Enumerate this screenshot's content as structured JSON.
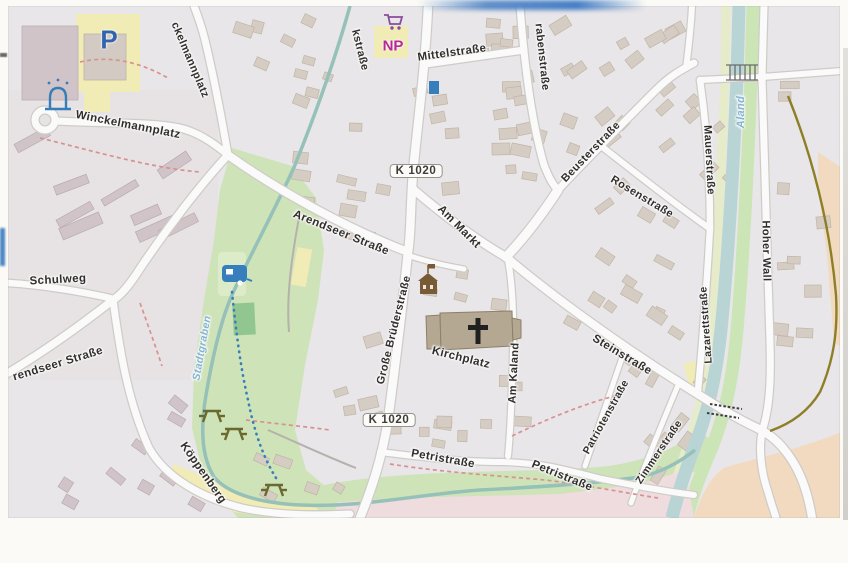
{
  "map": {
    "street_labels": [
      {
        "n": "street-label-kstrasse",
        "t": "kstraße",
        "x": 360,
        "y": 50,
        "r": 76,
        "s": 11
      },
      {
        "n": "street-label-mittelstrasse",
        "t": "Mittelstraße",
        "x": 452,
        "y": 53,
        "r": -8,
        "s": 11.5
      },
      {
        "n": "street-label-grabenstrasse",
        "t": "rabenstraße",
        "x": 542,
        "y": 57,
        "r": 84,
        "s": 11
      },
      {
        "n": "street-label-beusterstrasse",
        "t": "Beusterstraße",
        "x": 591,
        "y": 152,
        "r": -46,
        "s": 11
      },
      {
        "n": "street-label-rosenstrasse",
        "t": "Rosenstraße",
        "x": 642,
        "y": 197,
        "r": 31,
        "s": 11
      },
      {
        "n": "street-label-mauerstrasse",
        "t": "Mauerstraße",
        "x": 709,
        "y": 160,
        "r": 87,
        "s": 11
      },
      {
        "n": "water-label-aland",
        "t": "Aland",
        "x": 741,
        "y": 112,
        "r": -90,
        "s": 11,
        "wt": 1
      },
      {
        "n": "street-label-hoher-wall",
        "t": "Hoher Wall",
        "x": 766,
        "y": 251,
        "r": 89,
        "s": 11
      },
      {
        "n": "street-label-ckelmannplatz",
        "t": "ckelmannplatz",
        "x": 190,
        "y": 60,
        "r": 67,
        "s": 11
      },
      {
        "n": "street-label-winckelmannplatz",
        "t": "Winckelmannplatz",
        "x": 128,
        "y": 125,
        "r": 11,
        "s": 11.5
      },
      {
        "n": "street-label-arendseer-strasse",
        "t": "Arendseer Straße",
        "x": 341,
        "y": 233,
        "r": 22,
        "s": 11.5
      },
      {
        "n": "street-label-schulweg",
        "t": "Schulweg",
        "x": 58,
        "y": 280,
        "r": -3,
        "s": 11.5
      },
      {
        "n": "street-label-arendseer-strasse-west",
        "t": "rendseer Straße",
        "x": 58,
        "y": 364,
        "r": -17,
        "s": 11.5
      },
      {
        "n": "street-label-koeppenberg",
        "t": "Köppenberg",
        "x": 203,
        "y": 473,
        "r": 55,
        "s": 11.5
      },
      {
        "n": "water-label-stadtgraben",
        "t": "Stadtgraben",
        "x": 202,
        "y": 348,
        "r": -80,
        "s": 10.5,
        "wt": 1
      },
      {
        "n": "street-label-grosse-bruederstrasse",
        "t": "Große Brüderstraße",
        "x": 394,
        "y": 330,
        "r": -76,
        "s": 11
      },
      {
        "n": "street-label-am-markt",
        "t": "Am Markt",
        "x": 459,
        "y": 227,
        "r": 45,
        "s": 11.5
      },
      {
        "n": "street-label-kirchplatz",
        "t": "Kirchplatz",
        "x": 461,
        "y": 358,
        "r": 14,
        "s": 11.5
      },
      {
        "n": "street-label-am-kaland",
        "t": "Am Kaland",
        "x": 514,
        "y": 373,
        "r": -87,
        "s": 11
      },
      {
        "n": "street-label-steinstrasse",
        "t": "Steinstraße",
        "x": 622,
        "y": 355,
        "r": 31,
        "s": 11.5
      },
      {
        "n": "street-label-patriotenstrasse",
        "t": "Patriotenstraße",
        "x": 606,
        "y": 417,
        "r": -61,
        "s": 10.5
      },
      {
        "n": "street-label-zimmerstrasse",
        "t": "Zimmerstraße",
        "x": 659,
        "y": 452,
        "r": -56,
        "s": 10.5
      },
      {
        "n": "street-label-lazarettstrasse",
        "t": "Lazarettstraße",
        "x": 706,
        "y": 325,
        "r": -94,
        "s": 10.5
      },
      {
        "n": "street-label-petristrasse-west",
        "t": "Petristraße",
        "x": 443,
        "y": 459,
        "r": 10,
        "s": 11.5
      },
      {
        "n": "street-label-petristrasse-east",
        "t": "Petristraße",
        "x": 562,
        "y": 476,
        "r": 22,
        "s": 11.5
      }
    ],
    "road_badges": [
      {
        "n": "road-badge-k1020-north",
        "t": "K 1020",
        "x": 416,
        "y": 171
      },
      {
        "n": "road-badge-k1020-south",
        "t": "K 1020",
        "x": 389,
        "y": 420
      }
    ],
    "poi_labels": [
      {
        "n": "parking-label",
        "t": "P",
        "x": 109,
        "y": 40,
        "s": 26,
        "c": "#2a64b4"
      },
      {
        "n": "np-supermarket-label",
        "t": "NP",
        "x": 393,
        "y": 46,
        "s": 15,
        "c": "#c2219f"
      }
    ],
    "icons": [
      {
        "name": "parking-icon",
        "glyph": "P",
        "color": "#2a64b4"
      },
      {
        "name": "supermarket-cart-icon",
        "color": "#8d4a9e"
      },
      {
        "name": "fountain-icon",
        "color": "#2f7fc1"
      },
      {
        "name": "bus-stop-icon",
        "color": "#2e7fc4"
      },
      {
        "name": "town-hall-icon",
        "color": "#7a5a30"
      },
      {
        "name": "church-building-with-cross-icon",
        "color": "#1d1d1d"
      },
      {
        "name": "church-cross-icon",
        "color": "#1d1d1d"
      },
      {
        "name": "caravan-site-icon",
        "color": "#2e7fc4"
      },
      {
        "name": "picnic-table-icon",
        "color": "#6a6a26",
        "count": 3
      }
    ],
    "colors": {
      "base": "#ebe9ec",
      "building": "#d8cfc4",
      "road": "#fefefe",
      "road_casing": "#d2cec9",
      "park": "#cfe7b7",
      "river": "#b9d7d7",
      "stream": "#93c4ba",
      "pink_area": "#f4dee2",
      "orange_area": "#f7ddc0",
      "yellow_area": "#f5f0b2",
      "footpath_red": "#e09090",
      "route_blue": "#2e7fc4",
      "olive_path": "#8f7f1d",
      "label": "#2f2b28",
      "water_label": "#7fb7d8"
    }
  }
}
